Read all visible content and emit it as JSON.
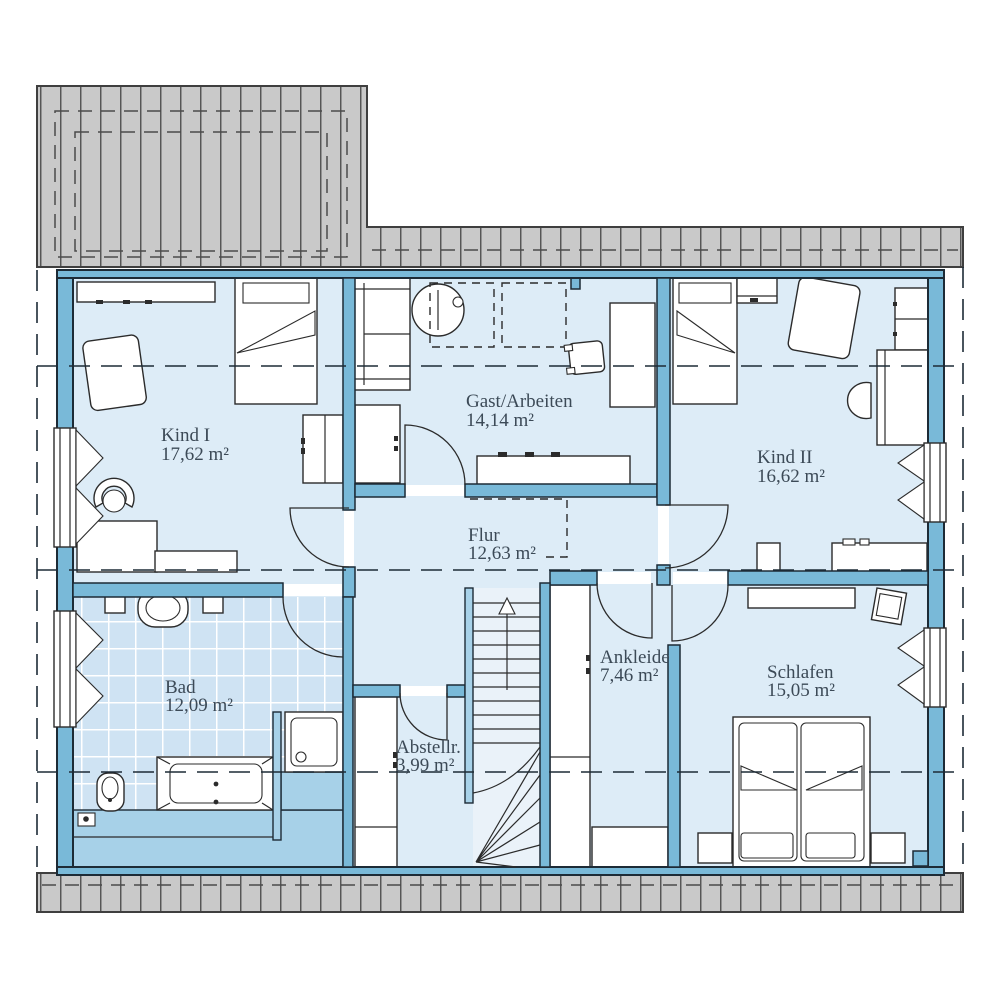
{
  "floorplan": {
    "type": "floor-plan",
    "rooms": [
      {
        "id": "kind1",
        "name": "Kind I",
        "area": "17,62 m²"
      },
      {
        "id": "gast",
        "name": "Gast/Arbeiten",
        "area": "14,14 m²"
      },
      {
        "id": "kind2",
        "name": "Kind II",
        "area": "16,62 m²"
      },
      {
        "id": "flur",
        "name": "Flur",
        "area": "12,63 m²"
      },
      {
        "id": "bad",
        "name": "Bad",
        "area": "12,09 m²"
      },
      {
        "id": "abstell",
        "name": "Abstellr.",
        "area": "3,99 m²"
      },
      {
        "id": "ankleide",
        "name": "Ankleide",
        "area": "7,46 m²"
      },
      {
        "id": "schlafen",
        "name": "Schlafen",
        "area": "15,05 m²"
      }
    ],
    "stairs": {
      "direction": "up"
    },
    "colors": {
      "wall": "#79b9d8",
      "ink": "#1d2b36",
      "room": "#ddecf7",
      "tile": "#cfe3f3",
      "knee": "#a7d1e8",
      "stair": "#eaf2f9",
      "roof": "#c9c9c9",
      "roofline": "#4f4f4f",
      "line": "#2b2b2b",
      "text": "#3c4a57"
    }
  }
}
